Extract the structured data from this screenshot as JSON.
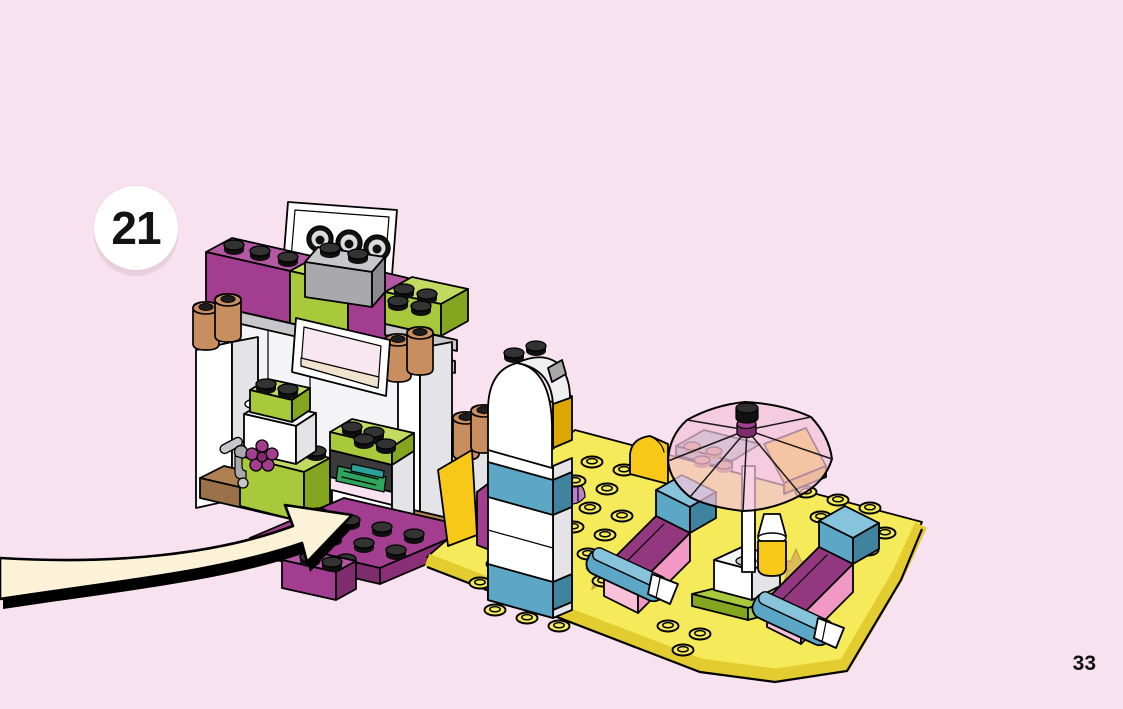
{
  "page": {
    "step_number": "21",
    "page_number": "33"
  },
  "palette": {
    "background": "#F9E2EF",
    "badge_bg": "#FFFFFF",
    "badge_text": "#141414",
    "arrow_fill": "#FBF2D8",
    "magenta": "#A23D8F",
    "magenta_dark": "#7E2C6E",
    "magenta_light": "#B558A3",
    "lime": "#A8C93C",
    "lime_light": "#C1DA5F",
    "lime_dark": "#84A51F",
    "white_brick": "#FFFFFF",
    "white_shade": "#E3E3E8",
    "gray_brick": "#A9A9AD",
    "gray_light": "#C7C7CB",
    "tan": "#C98E60",
    "tan_dark": "#A66F3F",
    "brown": "#9A7148",
    "yellow_plate": "#F5EA59",
    "yellow_plate_side": "#E2CC2F",
    "yellow_bright": "#F7C818",
    "yellow_bright_dark": "#DCA800",
    "azure": "#5CA7C6",
    "azure_dark": "#40839E",
    "azure_light": "#87C4DB",
    "pink_bright": "#F199C4",
    "pink_bright_light": "#F9C0DA",
    "trans_pink": "#F2C2DA",
    "mat_magenta": "#93377F",
    "money_green": "#2FA45C",
    "sand_blue": "#A3BCCB",
    "star_gold": "#D8B254",
    "shell_lavender": "#BB7FCB",
    "print_blue": "#4E9BD4"
  },
  "illustration": {
    "subject": "beach-kiosk-with-loungers-and-parasol-build-step"
  }
}
